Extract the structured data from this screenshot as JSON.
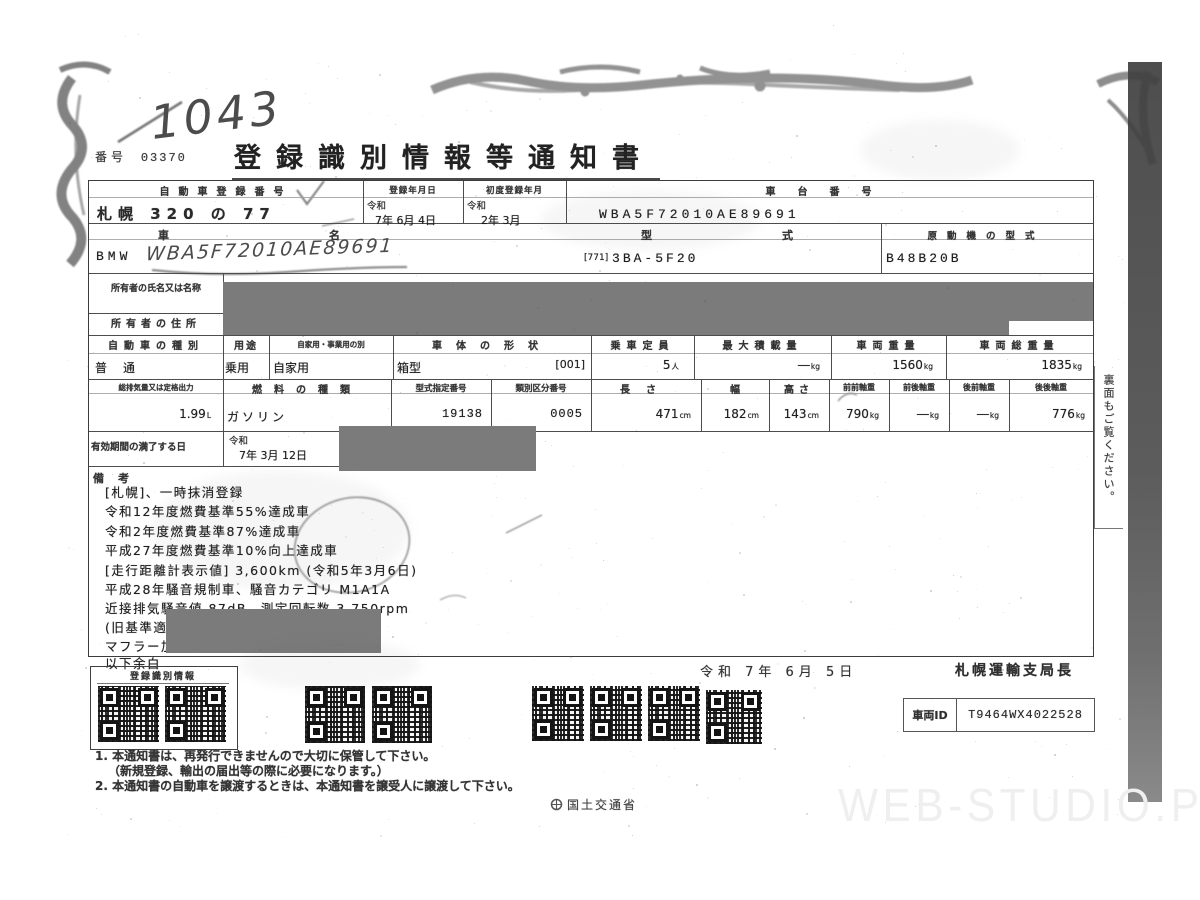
{
  "meta": {
    "doc_no_label": "番号",
    "doc_no": "03370",
    "title": "登録識別情報等通知書",
    "handwritten_no": "1043",
    "handwritten_vin": "WBA5F72010AE89691"
  },
  "table": {
    "reg_no": {
      "label": "自動車登録番号",
      "value": "札幌 320 の 77"
    },
    "reg_date": {
      "label": "登録年月日",
      "era": "令和",
      "value": "7年 6月 4日"
    },
    "first_reg": {
      "label": "初度登録年月",
      "era": "令和",
      "value": "2年 3月"
    },
    "chassis_no": {
      "label": "車台番号",
      "value": "WBA5F72010AE89691"
    },
    "car_name": {
      "label": "車名",
      "value": "BMW"
    },
    "model": {
      "label": "型式",
      "prefix": "[771]",
      "value": "3BA-5F20"
    },
    "engine_model": {
      "label": "原動機の型式",
      "value": "B48B20B"
    },
    "owner_name": {
      "label": "所有者の氏名又は名称"
    },
    "owner_addr": {
      "label": "所有者の住所"
    },
    "kind": {
      "label": "自動車の種別",
      "value": "普通"
    },
    "use": {
      "label": "用途",
      "value": "乗用"
    },
    "private_biz": {
      "label": "自家用・事業用の別",
      "value": "自家用"
    },
    "body": {
      "label": "車体の形状",
      "value": "箱型",
      "code": "[001]"
    },
    "capacity": {
      "label": "乗車定員",
      "value": "5",
      "unit": "人"
    },
    "max_load": {
      "label": "最大積載量",
      "value": "―",
      "unit": "kg"
    },
    "weight": {
      "label": "車両重量",
      "value": "1560",
      "unit": "kg"
    },
    "gross_weight": {
      "label": "車両総重量",
      "value": "1835",
      "unit": "kg"
    },
    "displacement": {
      "label": "総排気量又は定格出力",
      "value": "1.99",
      "unit": "L"
    },
    "fuel": {
      "label": "燃料の種類",
      "value": "ガソリン"
    },
    "type_cert_no": {
      "label": "型式指定番号",
      "value": "19138"
    },
    "class_no": {
      "label": "類別区分番号",
      "value": "0005"
    },
    "length": {
      "label": "長さ",
      "value": "471",
      "unit": "cm"
    },
    "width": {
      "label": "幅",
      "value": "182",
      "unit": "cm"
    },
    "height": {
      "label": "高さ",
      "value": "143",
      "unit": "cm"
    },
    "axle_ff": {
      "label": "前前軸重",
      "value": "790",
      "unit": "kg"
    },
    "axle_fr": {
      "label": "前後軸重",
      "value": "―",
      "unit": "kg"
    },
    "axle_rf": {
      "label": "後前軸重",
      "value": "―",
      "unit": "kg"
    },
    "axle_rr": {
      "label": "後後軸重",
      "value": "776",
      "unit": "kg"
    },
    "expiry": {
      "label": "有効期間の満了する日",
      "era": "令和",
      "value": "7年 3月 12日"
    },
    "remarks_label": "備考",
    "remarks": [
      "[札幌]、一時抹消登録",
      "令和12年度燃費基準55%達成車",
      "令和2年度燃費基準87%達成車",
      "平成27年度燃費基準10%向上達成車",
      "[走行距離計表示値] 3,600km (令和5年3月6日)",
      "平成28年騒音規制車、騒音カテゴリ M1A1A",
      "近接排気騒音値 87dB、測定回転数 3,750rpm",
      "(旧基準適用時測定回転数 3,750rpm)",
      "マフラー加速騒音規制適用車",
      "以下余白"
    ]
  },
  "footer": {
    "qr_box_label": "登録識別情報",
    "issue_date": "令和 7年 6月 5日",
    "authority": "札幌運輸支局長",
    "vehicle_id_label": "車両ID",
    "vehicle_id": "T9464WX4022528",
    "notes": [
      "1. 本通知書は、再発行できませんので大切に保管して下さい。",
      "（新規登録、輸出の届出等の際に必要になります。）",
      "2. 本通知書の自動車を譲渡するときは、本通知書を譲受人に譲渡して下さい。"
    ],
    "ministry": "国土交通省",
    "side_note": "裏面もご覧ください。",
    "watermark": "WEB-STUDIO.PRO"
  },
  "colors": {
    "redaction": "#7b7b7b",
    "scan_bar_dark": "#4e4e4e",
    "scan_bar_light": "#8a8a8a",
    "ink": "#3a3a3a"
  }
}
